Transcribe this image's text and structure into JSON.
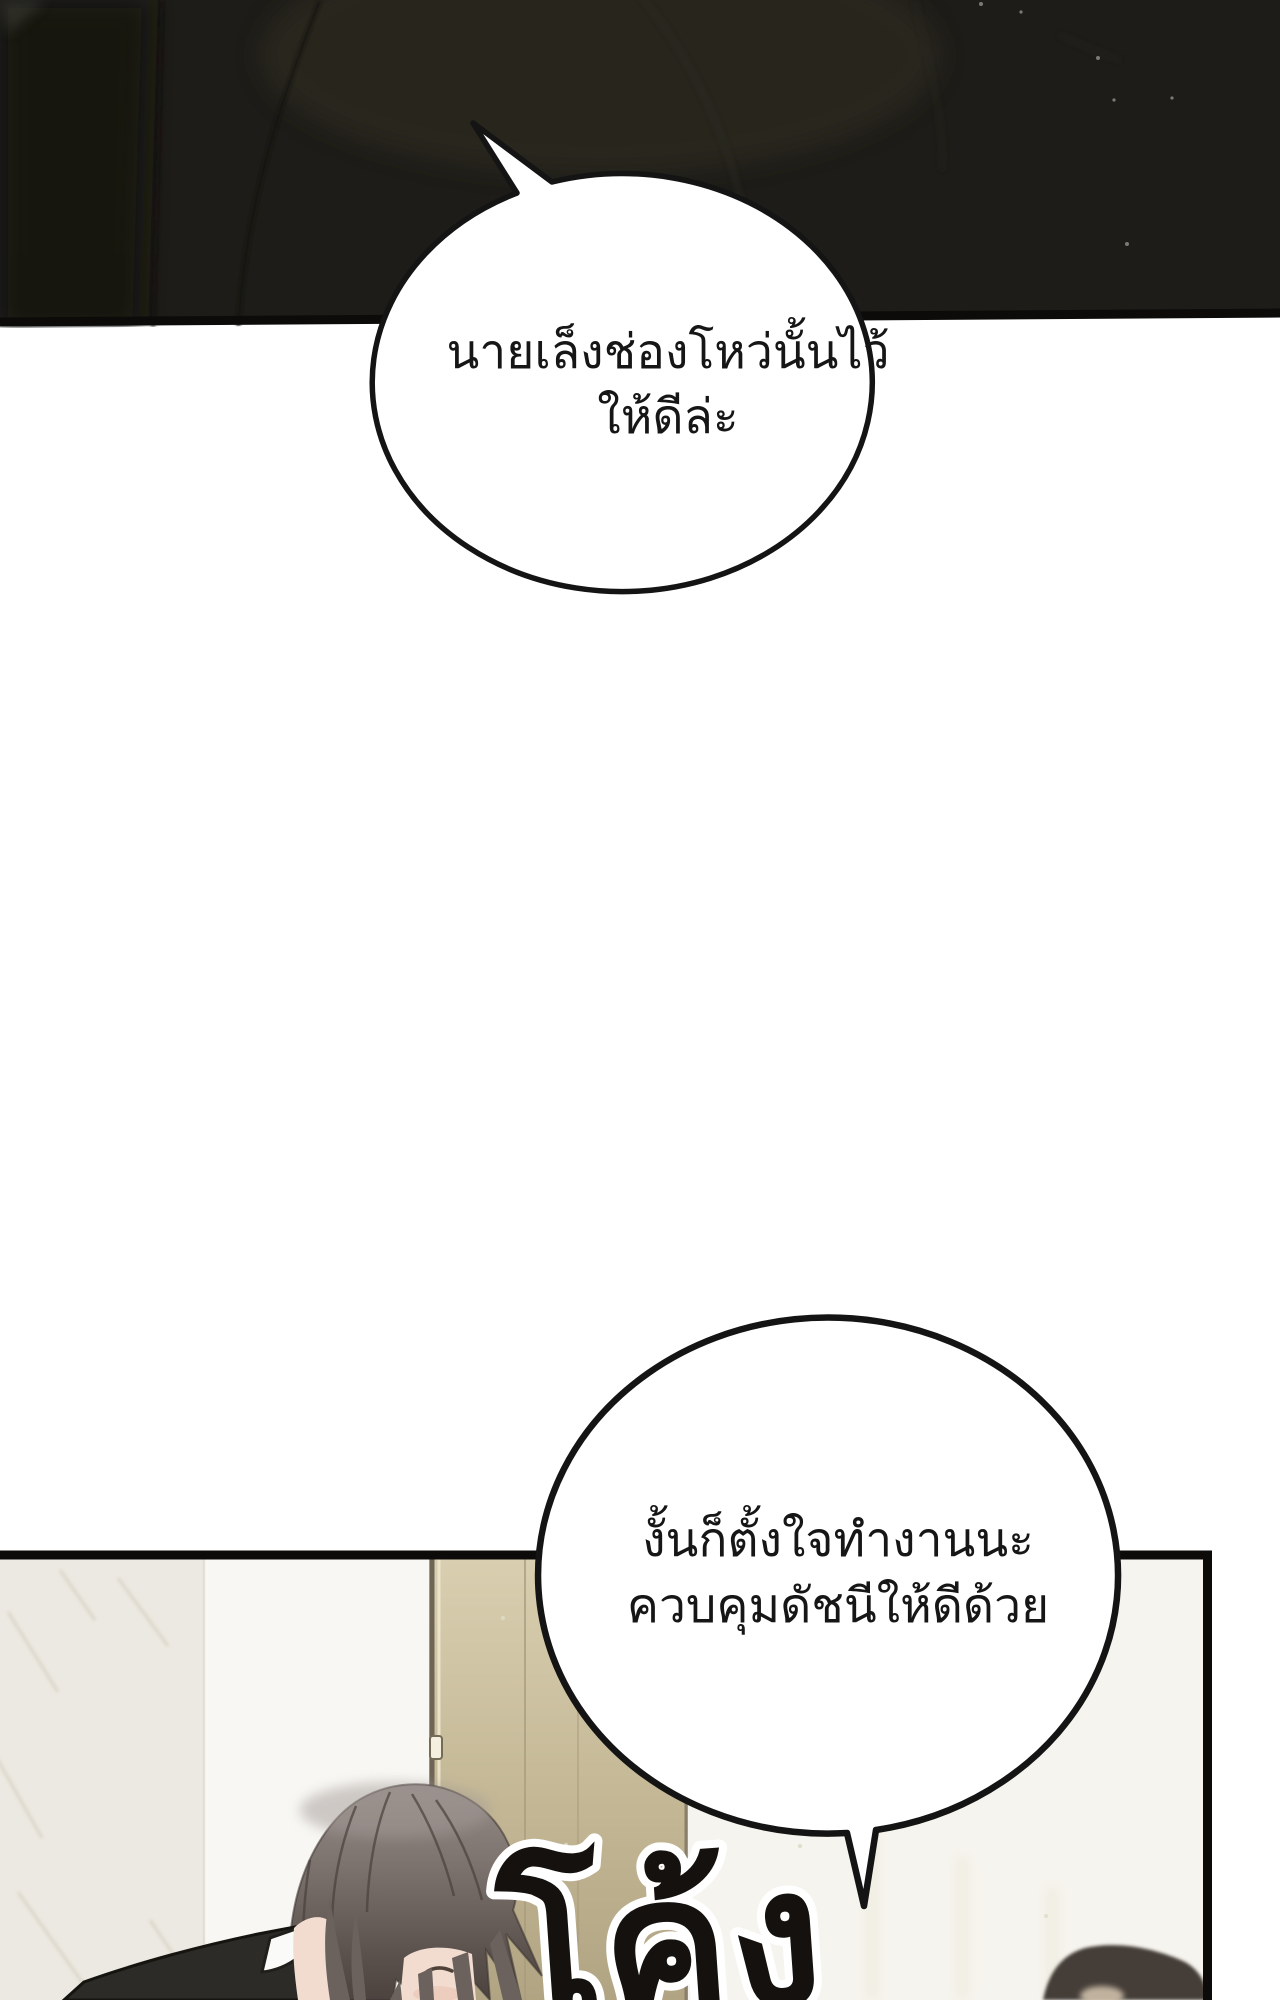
{
  "page": {
    "width": 1280,
    "height": 2000
  },
  "bubbles": {
    "bubble1": {
      "line1": "นายเล็งช่องโหว่นั้นไว้",
      "line2": "ให้ดีล่ะ"
    },
    "bubble2": {
      "line1": "งั้นก็ตั้งใจทำงานนะ",
      "line2": "ควบคุมดัชนีให้ดีด้วย"
    }
  },
  "sfx": {
    "text": "โค้ง"
  },
  "colors": {
    "page_bg": "#ffffff",
    "ink": "#141414",
    "border": "#0c0b09",
    "panel1_base": "#1d1c18",
    "panel1_left": "#161511",
    "panel1_brown": "#312d22",
    "marble": "#ece9e2",
    "marble_vein": "#d8d2c4",
    "wall_white": "#f8f7f3",
    "wall_right": "#f6f4ee",
    "door_top": "#d9cfb0",
    "door_bottom": "#b0a483",
    "door_frame": "#6e6555",
    "hair_light": "#978d89",
    "hair_dark": "#4c433f",
    "skin": "#f2dccf",
    "blush": "#eac3b0",
    "suit": "#2d2b28",
    "collar": "#fafaf8",
    "blob": "#453e37",
    "blob_light": "#cdbfa9",
    "sfx_fill": "#14110e",
    "sfx_halo": "#ffffff"
  }
}
